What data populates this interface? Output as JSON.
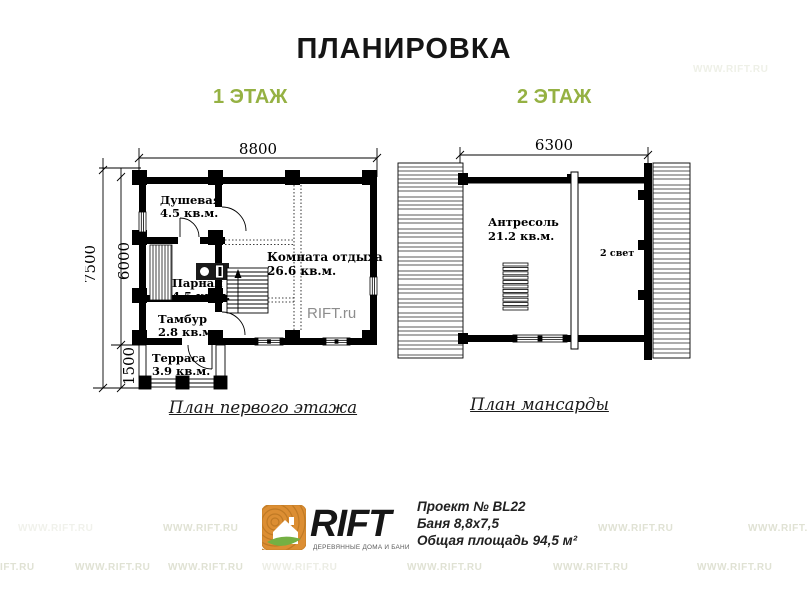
{
  "title": "ПЛАНИРОВКА",
  "floors": {
    "first_label": "1 ЭТАЖ",
    "second_label": "2 ЭТАЖ"
  },
  "plan1": {
    "caption": "План первого этажа",
    "dims": {
      "width": "8800",
      "height_total": "7500",
      "height_main": "6000",
      "height_terrace": "1500"
    },
    "rooms": {
      "shower": {
        "name": "Душевая",
        "area": "4.5 кв.м."
      },
      "steam": {
        "name": "Парная",
        "area": "4.5 кв.м."
      },
      "hall": {
        "name": "Тамбур",
        "area": "2.8 кв.м."
      },
      "terrace": {
        "name": "Терраса",
        "area": "3.9 кв.м."
      },
      "lounge": {
        "name": "Комната отдыха",
        "area": "26.6 кв.м."
      }
    },
    "watermark": "RIFT.ru"
  },
  "plan2": {
    "caption": "План мансарды",
    "dims": {
      "width": "6300"
    },
    "rooms": {
      "mezzanine": {
        "name": "Антресоль",
        "area": "21.2 кв.м."
      }
    },
    "note": "2 свет"
  },
  "footer": {
    "logo_text": "RIFT",
    "logo_tagline": "ДЕРЕВЯННЫЕ ДОМА И БАНИ",
    "project_number": "Проект № BL22",
    "project_size": "Баня 8,8х7,5",
    "project_area": "Общая площадь 94,5 м²"
  },
  "watermarks": {
    "full": "WWW.RIFT.RU",
    "partial": "IFT.RU"
  },
  "colors": {
    "accent_green": "#95b143",
    "logo_orange": "#dc8e33",
    "leaf_green": "#74b043",
    "ink": "#000000"
  }
}
